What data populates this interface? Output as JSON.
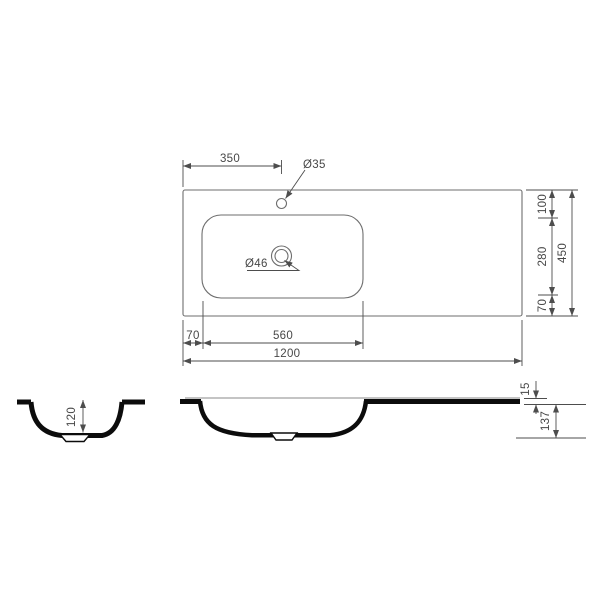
{
  "meta": {
    "description": "Technical dimension drawing of a rectangular countertop washbasin: top view with chained dimensions, side cross-section and front cross-section",
    "units_implied": "mm",
    "colors": {
      "background": "#ffffff",
      "outline": "#6e6e6e",
      "dimension": "#4d4d4d",
      "section_fill": "#0c0c0c"
    }
  },
  "top_view": {
    "dim_faucet_center_offset": "350",
    "label_faucet_hole_diameter": "Ø35",
    "label_drain_hole_diameter": "Ø46",
    "dim_back_edge_to_basin": "100",
    "dim_basin_front_to_back": "280",
    "dim_basin_to_front_edge": "70",
    "dim_overall_depth": "450",
    "dim_left_edge_to_basin": "70",
    "dim_basin_width": "560",
    "dim_overall_width": "1200"
  },
  "side_section_view": {
    "dim_bowl_inner_depth": "120"
  },
  "front_section_view": {
    "dim_rim_thickness": "15",
    "dim_body_height": "137"
  }
}
